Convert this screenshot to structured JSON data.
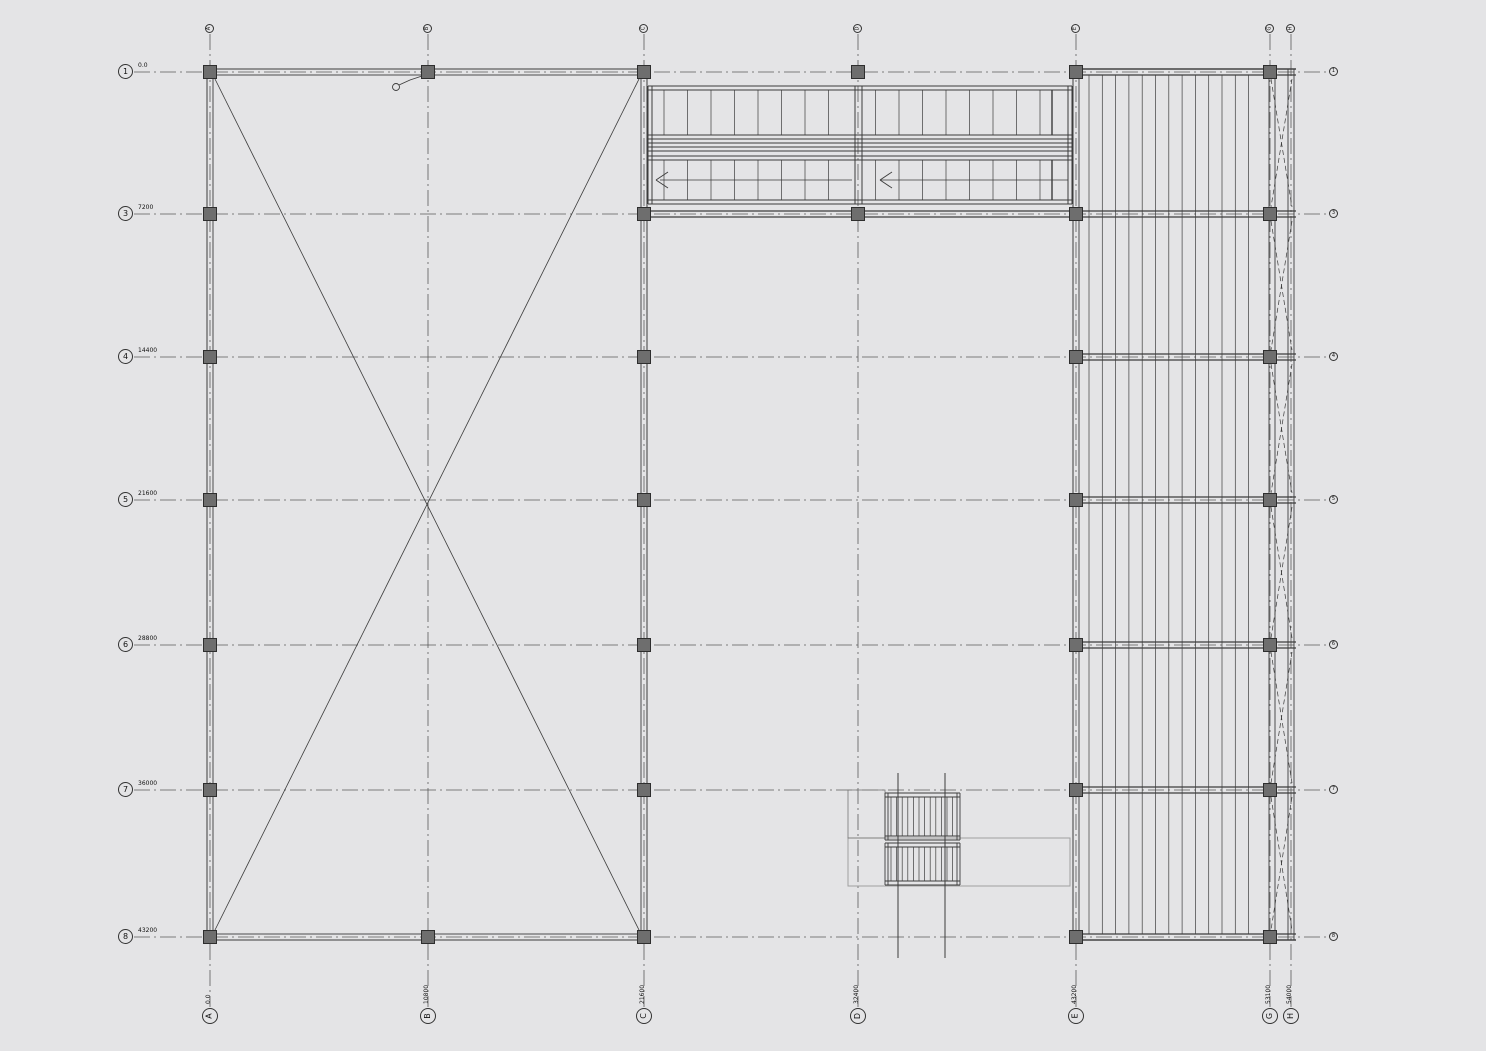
{
  "drawing": {
    "type": "structural-framing-plan",
    "background": "#e4e4e6",
    "line_color": "#3c3c3c",
    "grid_line_color": "#5a5a5a",
    "column_fill": "#6e6e6e",
    "faint_line_color": "#a0a0a0",
    "icons": {
      "grid_bubble": "circle-with-label-icon",
      "leader_tag": "small-circle-leader-icon",
      "direction_arrow": "left-chevron-arrow-icon"
    }
  },
  "grid": {
    "rows": [
      {
        "label": "1",
        "dimension": "0.0",
        "y": 72
      },
      {
        "label": "3",
        "dimension": "7200",
        "y": 214
      },
      {
        "label": "4",
        "dimension": "14400",
        "y": 357
      },
      {
        "label": "5",
        "dimension": "21600",
        "y": 500
      },
      {
        "label": "6",
        "dimension": "28800",
        "y": 645
      },
      {
        "label": "7",
        "dimension": "36000",
        "y": 790
      },
      {
        "label": "8",
        "dimension": "43200",
        "y": 937
      }
    ],
    "cols": [
      {
        "label": "A",
        "dimension": "0.0",
        "x": 210
      },
      {
        "label": "B",
        "dimension": "10800",
        "x": 428
      },
      {
        "label": "C",
        "dimension": "21600",
        "x": 644
      },
      {
        "label": "D",
        "dimension": "32400",
        "x": 858
      },
      {
        "label": "E",
        "dimension": "43200",
        "x": 1076
      },
      {
        "label": "G",
        "dimension": "53100",
        "x": 1270
      },
      {
        "label": "H",
        "dimension": "54000",
        "x": 1291
      }
    ]
  }
}
